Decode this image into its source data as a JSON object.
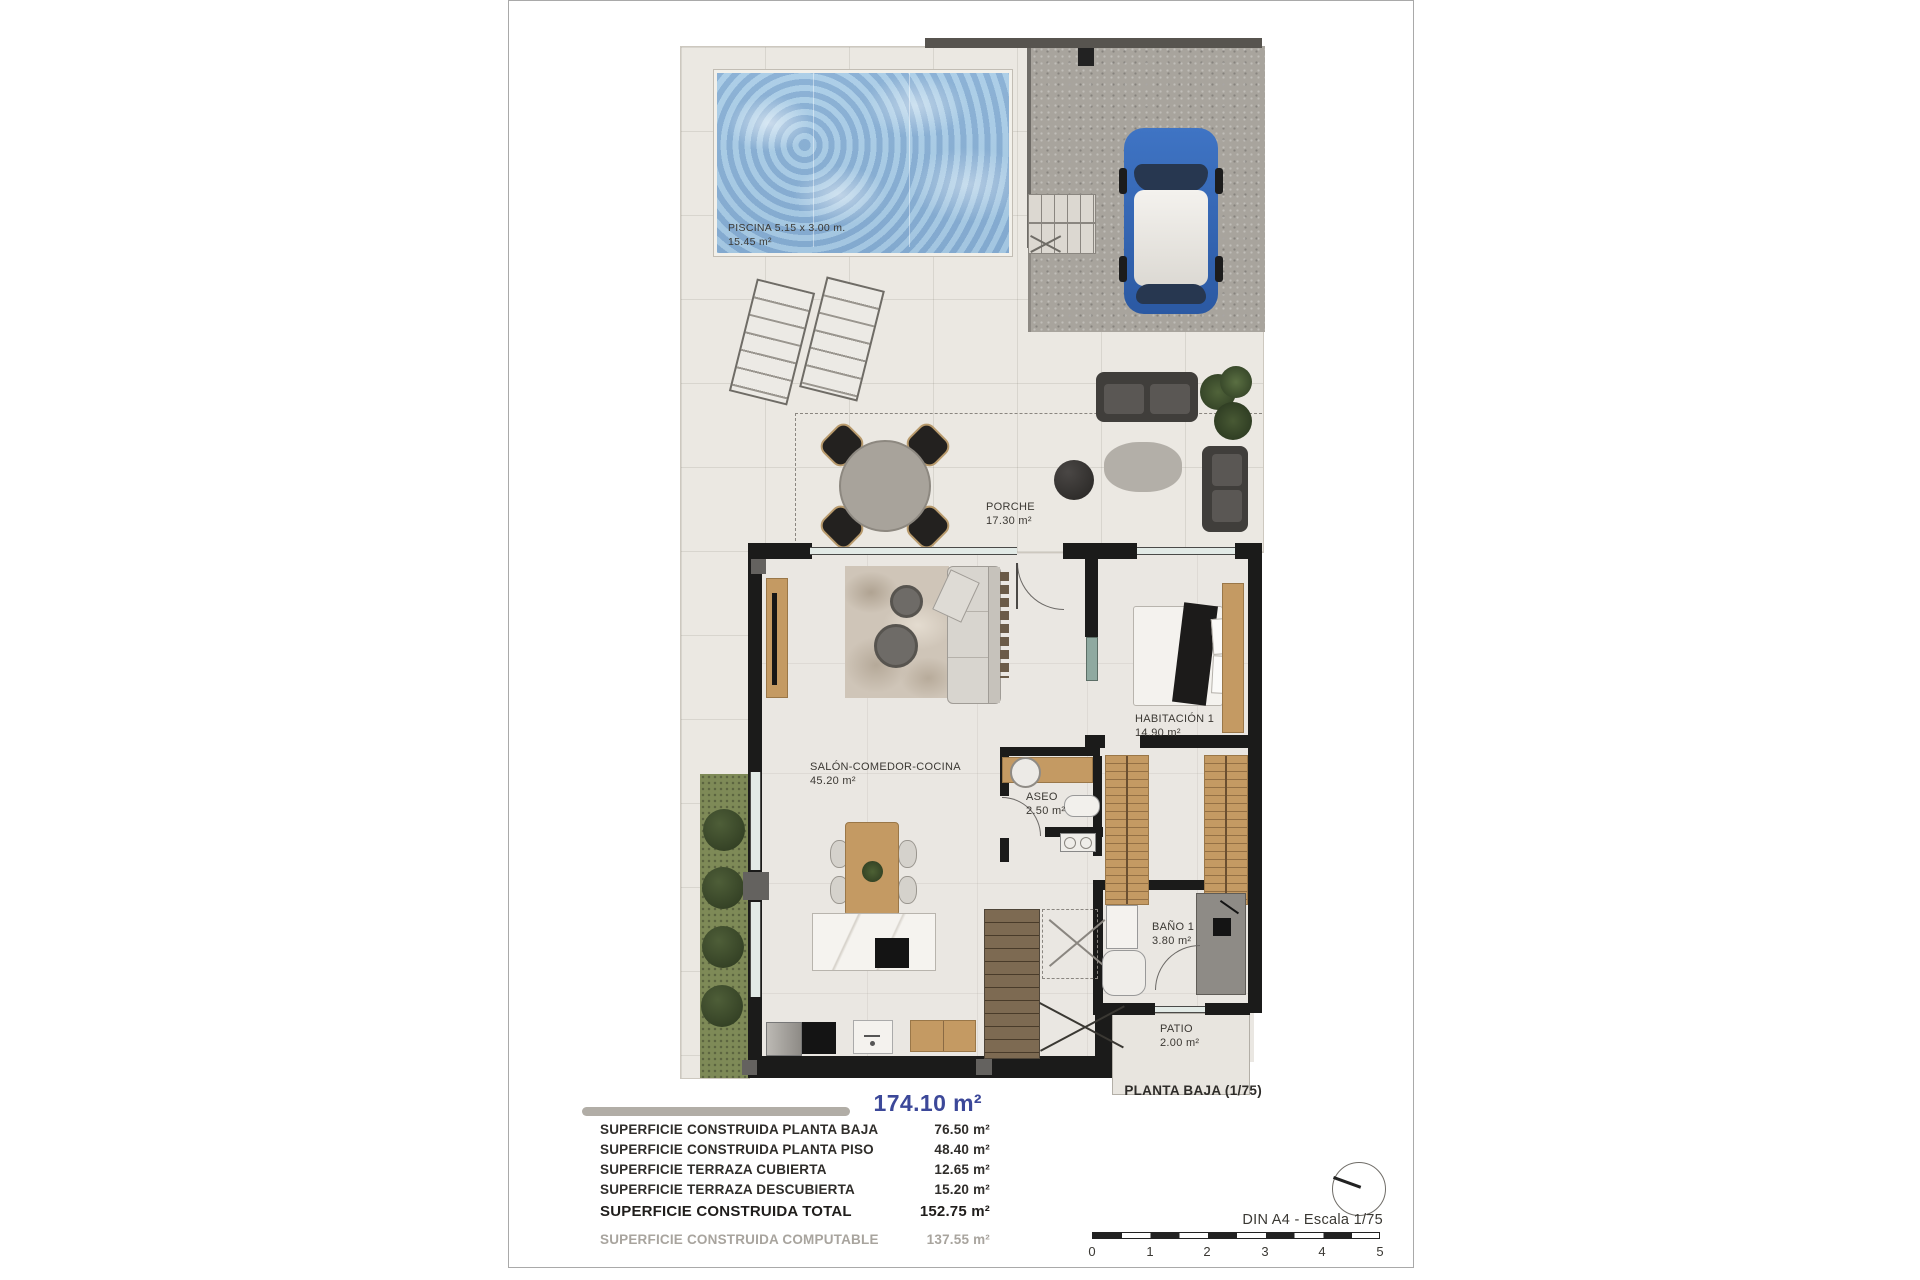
{
  "plan": {
    "piscina": {
      "name": "PISCINA 5.15 x 3.00 m.",
      "area": "15.45 m²"
    },
    "porche": {
      "name": "PORCHE",
      "area": "17.30 m²"
    },
    "salon": {
      "name": "SALÓN-COMEDOR-COCINA",
      "area": "45.20 m²"
    },
    "habitacion1": {
      "name": "HABITACIÓN 1",
      "area": "14.90 m²"
    },
    "aseo": {
      "name": "ASEO",
      "area": "2.50 m²"
    },
    "bano1": {
      "name": "BAÑO 1",
      "area": "3.80 m²"
    },
    "patio": {
      "name": "PATIO",
      "area": "2.00 m²"
    },
    "floor_label": "PLANTA BAJA (1/75)"
  },
  "summary": {
    "total_area": "174.10 m²",
    "rows": [
      {
        "label": "SUPERFICIE CONSTRUIDA PLANTA BAJA",
        "value": "76.50 m²"
      },
      {
        "label": "SUPERFICIE CONSTRUIDA PLANTA PISO",
        "value": "48.40 m²"
      },
      {
        "label": "SUPERFICIE TERRAZA CUBIERTA",
        "value": "12.65 m²"
      },
      {
        "label": "SUPERFICIE TERRAZA DESCUBIERTA",
        "value": "15.20 m²"
      }
    ],
    "total_row": {
      "label": "SUPERFICIE CONSTRUIDA TOTAL",
      "value": "152.75 m²"
    },
    "computable_row": {
      "label": "SUPERFICIE CONSTRUIDA COMPUTABLE",
      "value": "137.55 m²"
    }
  },
  "scale": {
    "caption": "DIN A4 - Escala 1/75",
    "ticks": [
      "0",
      "1",
      "2",
      "3",
      "4",
      "5"
    ]
  },
  "colors": {
    "accent_blue": "#3c4899",
    "wall_black": "#1b1b1a",
    "pool_water": "#9cc2e0",
    "wood": "#c49a63",
    "terrace": "#ebe8e2",
    "parking_gray": "#a8a49d",
    "muted_text": "#a8a49e",
    "car_blue": "#2f66b8"
  }
}
